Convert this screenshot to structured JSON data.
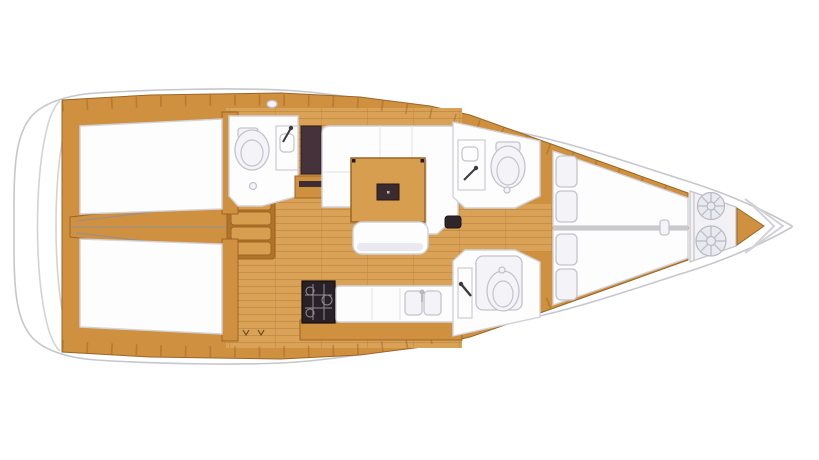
{
  "page": {
    "background": "#ffffff"
  },
  "palette": {
    "hull_fill": "#ffffff",
    "hull_outline": "#c6c6cd",
    "transom_line": "#d2d2d9",
    "wood_mid": "#cf9040",
    "wood_dark": "#9c6524",
    "wood_deep": "#b07428",
    "wood_table": "#d79e4f",
    "floor": "#d9a257",
    "plank_line": "#b0772f",
    "white_furniture": "#fdfdfe",
    "furniture_outline": "#d2d2da",
    "furniture_shade": "#e9e9ef",
    "fixture_fill": "#f4f4f8",
    "fixture_outline": "#c3c3cc",
    "dark_brown": "#46323a",
    "near_black": "#2a2126",
    "grid_gray": "#8f8f96",
    "coil_fill": "#e9eaef",
    "coil_stroke": "#b9bac3"
  },
  "plan": {
    "vessel": "sailboat-deck-plan-top-view",
    "orientation": {
      "bow": "right",
      "stern": "left"
    },
    "areas": [
      {
        "id": "swim-platform",
        "label": "stern swim platform"
      },
      {
        "id": "aft-cabin-port",
        "label": "aft double cabin (top)"
      },
      {
        "id": "aft-cabin-starboard",
        "label": "aft double cabin (bottom)"
      },
      {
        "id": "engine-compartment",
        "label": "engine compartment between aft cabins"
      },
      {
        "id": "companionway-steps",
        "label": "companionway steps"
      },
      {
        "id": "aft-head",
        "label": "aft head with toilet and basin"
      },
      {
        "id": "wardrobe",
        "label": "dark wardrobe locker"
      },
      {
        "id": "saloon",
        "label": "saloon with U-settee, wood table and bench"
      },
      {
        "id": "galley",
        "label": "galley with stove and twin sinks"
      },
      {
        "id": "forward-head-port",
        "label": "forward head, basin and toilet (top)"
      },
      {
        "id": "forward-head-starboard",
        "label": "forward shower head (bottom)"
      },
      {
        "id": "forward-cabin",
        "label": "forward V-berth cabin with pillows"
      },
      {
        "id": "anchor-locker",
        "label": "bow anchor locker with rope coils"
      }
    ]
  }
}
